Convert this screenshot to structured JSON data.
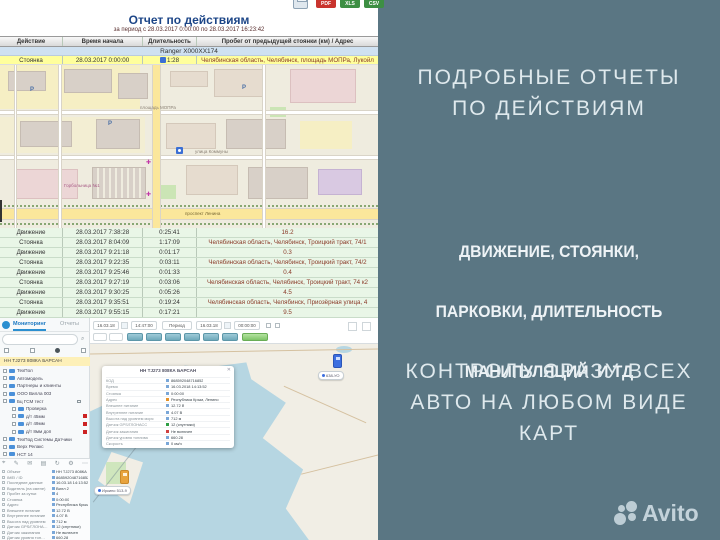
{
  "colors": {
    "canvas_teal": "#5a7683",
    "promo_text": "#dfe9ed",
    "report_title_blue": "#1c4587",
    "row_yellow": "#ffff9c",
    "row_green": "#e9f6e7",
    "address_red": "#8a3a28",
    "pdf_red": "#c9342e",
    "xls_green": "#3d8f43",
    "map_water": "#b6d6e2",
    "map_land": "#f1eee5"
  },
  "report": {
    "title": "Отчет по действиям",
    "period": "за период с 28.03.2017 0:00:00 по 28.03.2017 16:23:42",
    "export_buttons": [
      "PDF",
      "XLS",
      "CSV"
    ],
    "columns": [
      "Действие",
      "Время начала",
      "Длительность",
      "Пробег от предыдущей стоянки (км) / Адрес"
    ],
    "vehicle_group": "Ranger X000XX174",
    "first_row": {
      "action": "Стоянка",
      "start": "28.03.2017 0:00:00",
      "duration": "1:28",
      "info": "Челябинская область, Челябинск, площадь МОПРа, Лукойл"
    },
    "rows": [
      {
        "action": "Движение",
        "start": "28.03.2017 7:38:28",
        "duration": "0:25:41",
        "info": "16.2"
      },
      {
        "action": "Стоянка",
        "start": "28.03.2017 8:04:09",
        "duration": "1:17:09",
        "info": "Челябинская область, Челябинск, Троицкий тракт, 74/1"
      },
      {
        "action": "Движение",
        "start": "28.03.2017 9:21:18",
        "duration": "0:01:17",
        "info": "0.3"
      },
      {
        "action": "Стоянка",
        "start": "28.03.2017 9:22:35",
        "duration": "0:03:11",
        "info": "Челябинская область, Челябинск, Троицкий тракт, 74/2"
      },
      {
        "action": "Движение",
        "start": "28.03.2017 9:25:46",
        "duration": "0:01:33",
        "info": "0.4"
      },
      {
        "action": "Стоянка",
        "start": "28.03.2017 9:27:19",
        "duration": "0:03:06",
        "info": "Челябинская область, Челябинск, Троицкий тракт, 74 к2"
      },
      {
        "action": "Движение",
        "start": "28.03.2017 9:30:25",
        "duration": "0:05:26",
        "info": "4.5"
      },
      {
        "action": "Стоянка",
        "start": "28.03.2017 9:35:51",
        "duration": "0:19:24",
        "info": "Челябинская область, Челябинск, Приозёрная улица, 4"
      },
      {
        "action": "Движение",
        "start": "28.03.2017 9:55:15",
        "duration": "0:17:21",
        "info": "9.5"
      }
    ]
  },
  "city_map": {
    "street_1": "площадь МОПРа",
    "street_2": "улица Коммуны",
    "street_3": "проспект Ленина",
    "poi_hospital": "Горбольница №1",
    "parking_letter": "P"
  },
  "tracker": {
    "tab_active": "Мониторинг",
    "tab_inactive": "Отчеты",
    "selected_object": "НН ТJ273 808КА БАРСАН",
    "tree": [
      "ТехПол",
      "Автомодель",
      "Партнеры и клиенты",
      "ООО Вилла 003",
      "Бц ГСМ тест",
      "Проверка",
      "д/т 45мм",
      "д/т 49мм",
      "д/т 8мм доп",
      "ТехПод Системы Датчики",
      "Верх Релакс",
      "НСТ 14"
    ],
    "toolbar": {
      "date_from": "16.03.18",
      "time_from": "14:47:00",
      "period_label": "Период",
      "date_to": "16.03.18",
      "time_to": "00:00:00"
    },
    "popup": {
      "title": "НН ТJ273 808КА БАРСАН",
      "rows": [
        [
          "КОД",
          "868592048716852"
        ],
        [
          "Время",
          "16.03.2018 14:13:52"
        ],
        [
          "Стоянка",
          "0:00:00"
        ],
        [
          "Адрес",
          "Республика Крым, Ленино"
        ],
        [
          "Внешнее питание",
          "12.72 В"
        ],
        [
          "Внутреннее питание",
          "4.07 В"
        ],
        [
          "Высота над уровнем моря",
          "712 м"
        ],
        [
          "Датчик GPS/ГЛОНАСС",
          "12 (спутники)"
        ],
        [
          "Датчик зажигания",
          "Не включен"
        ],
        [
          "Датчик уровня топлива",
          "660.28"
        ],
        [
          "Скорость",
          "0 км/ч"
        ]
      ]
    },
    "details": {
      "rows": [
        [
          "Объект",
          "НН ТJ273 808КА Б…"
        ],
        [
          "IMEI / ID",
          "868592048716852"
        ],
        [
          "Последние данные",
          "16.03.18 14:13:52"
        ],
        [
          "Водитель (на смене)",
          "Вилл 2"
        ],
        [
          "Пробег за сутки",
          "4"
        ],
        [
          "Стоянка",
          "0:00:00"
        ],
        [
          "Адрес",
          "Республика Крым…"
        ],
        [
          "Внешнее питание",
          "12.72 В"
        ],
        [
          "Внутреннее питание",
          "4.07 В"
        ],
        [
          "Высота над уровнем",
          "712 м"
        ],
        [
          "Датчик GPS/ГЛОНА…",
          "12 (спутники)"
        ],
        [
          "Датчик зажигания",
          "Не включен"
        ],
        [
          "Датчик уровня топ…",
          "660.28"
        ]
      ]
    },
    "marker_1": "638-УО",
    "marker_2": "Иркино 513-9"
  },
  "promo": {
    "h1": [
      "ПОДРОБНЫЕ ОТЧЕТЫ",
      "ПО ДЕЙСТВИЯМ"
    ],
    "h2": [
      "ДВИЖЕНИЕ, СТОЯНКИ,",
      "ПАРКОВКИ, ДЛИТЕЛЬНОСТЬ",
      "МАНИПУЛЯЦИЙ  И ТД"
    ],
    "h3": [
      "КОНТРОЛЬ СРАЗУ ВСЕХ",
      "АВТО НА ЛЮБОМ ВИДЕ",
      "КАРТ"
    ]
  },
  "brand": {
    "name": "Avito"
  }
}
